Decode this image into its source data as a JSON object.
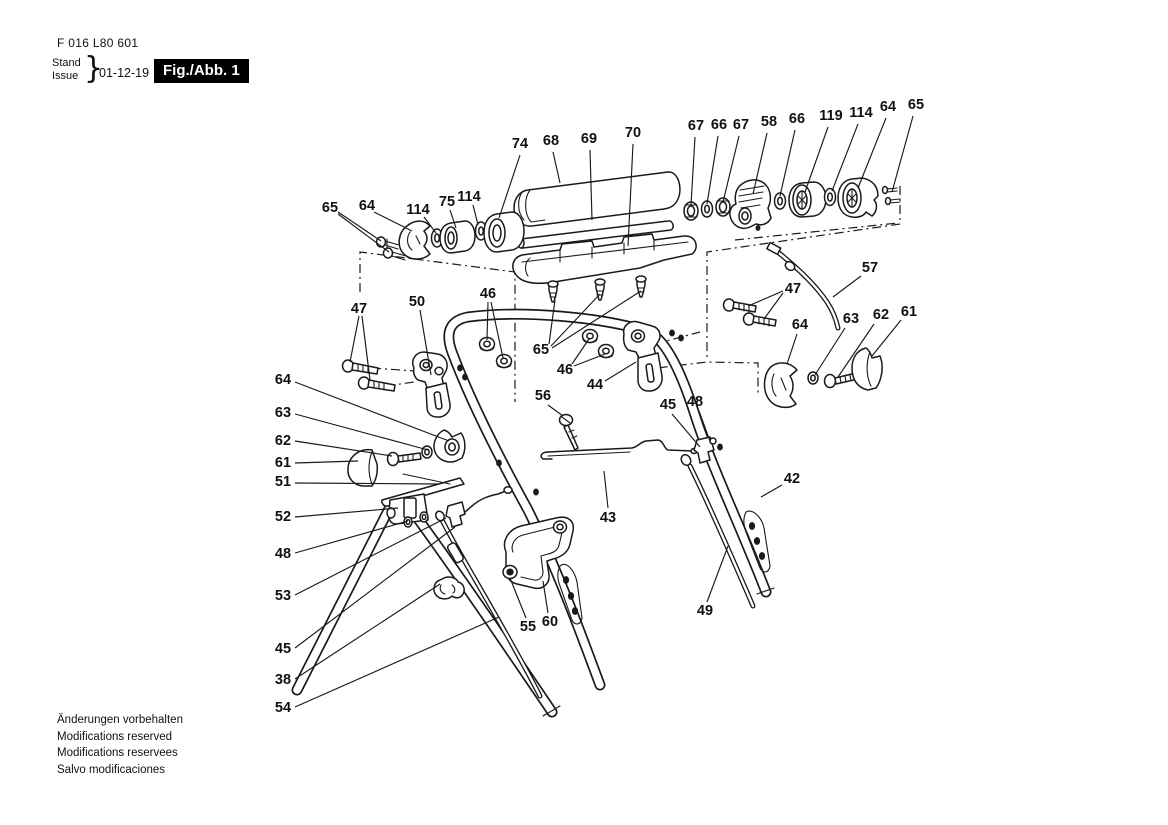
{
  "header": {
    "doc_number": "F 016 L80 601",
    "stand_label": "Stand",
    "issue_label": "Issue",
    "brace": "}",
    "date": "01-12-19",
    "figure_label": "Fig./Abb. 1"
  },
  "footer": {
    "lines": [
      "Änderungen vorbehalten",
      "Modifications reserved",
      "Modifications reservees",
      "Salvo modificaciones"
    ]
  },
  "colors": {
    "ink": "#1a1a1a",
    "figure_box_bg": "#000000",
    "figure_box_text": "#ffffff",
    "paper": "#ffffff"
  },
  "diagram": {
    "description": "Exploded-view spare parts drawing of a lawn-mower upper/lower handle assembly",
    "parts": [
      {
        "num": "74",
        "x": 520,
        "y": 148,
        "leaders": [
          [
            520,
            155,
            499,
            218
          ]
        ]
      },
      {
        "num": "68",
        "x": 551,
        "y": 145,
        "leaders": [
          [
            553,
            152,
            560,
            183
          ]
        ]
      },
      {
        "num": "69",
        "x": 589,
        "y": 143,
        "leaders": [
          [
            590,
            150,
            592,
            220
          ]
        ]
      },
      {
        "num": "70",
        "x": 633,
        "y": 137,
        "leaders": [
          [
            633,
            144,
            628,
            246
          ]
        ]
      },
      {
        "num": "67",
        "x": 696,
        "y": 130,
        "leaders": [
          [
            695,
            137,
            691,
            205
          ]
        ]
      },
      {
        "num": "66",
        "x": 719,
        "y": 129,
        "leaders": [
          [
            718,
            136,
            707,
            204
          ]
        ]
      },
      {
        "num": "67",
        "x": 741,
        "y": 129,
        "leaders": [
          [
            739,
            136,
            723,
            202
          ]
        ]
      },
      {
        "num": "58",
        "x": 769,
        "y": 126,
        "leaders": [
          [
            767,
            133,
            753,
            194
          ]
        ]
      },
      {
        "num": "66",
        "x": 797,
        "y": 123,
        "leaders": [
          [
            795,
            130,
            780,
            196
          ]
        ]
      },
      {
        "num": "119",
        "x": 831,
        "y": 120,
        "leaders": [
          [
            828,
            127,
            805,
            192
          ]
        ]
      },
      {
        "num": "114",
        "x": 861,
        "y": 117,
        "leaders": [
          [
            858,
            124,
            832,
            191
          ]
        ]
      },
      {
        "num": "64",
        "x": 888,
        "y": 111,
        "leaders": [
          [
            886,
            118,
            858,
            188
          ]
        ]
      },
      {
        "num": "65",
        "x": 916,
        "y": 109,
        "leaders": [
          [
            913,
            116,
            892,
            192
          ]
        ]
      },
      {
        "num": "65",
        "x": 330,
        "y": 212,
        "leaders": [
          [
            338,
            212,
            381,
            241
          ],
          [
            338,
            214,
            389,
            252
          ]
        ]
      },
      {
        "num": "64",
        "x": 367,
        "y": 210,
        "leaders": [
          [
            374,
            212,
            412,
            231
          ]
        ]
      },
      {
        "num": "114",
        "x": 418,
        "y": 214,
        "leaders": [
          [
            424,
            217,
            436,
            233
          ]
        ]
      },
      {
        "num": "75",
        "x": 447,
        "y": 206,
        "leaders": [
          [
            450,
            210,
            456,
            228
          ]
        ]
      },
      {
        "num": "114",
        "x": 469,
        "y": 201,
        "leaders": [
          [
            473,
            205,
            478,
            225
          ]
        ]
      },
      {
        "num": "47",
        "x": 359,
        "y": 313,
        "leaders": [
          [
            359,
            316,
            350,
            362
          ],
          [
            362,
            316,
            370,
            380
          ]
        ]
      },
      {
        "num": "50",
        "x": 417,
        "y": 306,
        "leaders": [
          [
            420,
            310,
            431,
            375
          ]
        ]
      },
      {
        "num": "46",
        "x": 488,
        "y": 298,
        "leaders": [
          [
            488,
            302,
            487,
            340
          ],
          [
            491,
            302,
            503,
            358
          ]
        ]
      },
      {
        "num": "65",
        "x": 541,
        "y": 354,
        "leaders": [
          [
            549,
            344,
            555,
            300
          ],
          [
            551,
            346,
            600,
            294
          ],
          [
            552,
            348,
            641,
            291
          ]
        ]
      },
      {
        "num": "46",
        "x": 565,
        "y": 374,
        "leaders": [
          [
            572,
            364,
            589,
            339
          ],
          [
            574,
            366,
            605,
            354
          ]
        ]
      },
      {
        "num": "44",
        "x": 595,
        "y": 389,
        "leaders": [
          [
            605,
            381,
            636,
            362
          ]
        ]
      },
      {
        "num": "56",
        "x": 543,
        "y": 400,
        "leaders": [
          [
            548,
            405,
            563,
            416
          ]
        ]
      },
      {
        "num": "47",
        "x": 793,
        "y": 293,
        "leaders": [
          [
            783,
            291,
            748,
            306
          ],
          [
            783,
            293,
            764,
            319
          ]
        ]
      },
      {
        "num": "57",
        "x": 870,
        "y": 272,
        "leaders": [
          [
            861,
            276,
            833,
            297
          ]
        ]
      },
      {
        "num": "64",
        "x": 800,
        "y": 329,
        "leaders": [
          [
            797,
            334,
            787,
            364
          ]
        ]
      },
      {
        "num": "63",
        "x": 851,
        "y": 323,
        "leaders": [
          [
            845,
            328,
            815,
            375
          ]
        ]
      },
      {
        "num": "62",
        "x": 881,
        "y": 319,
        "leaders": [
          [
            874,
            324,
            838,
            377
          ]
        ]
      },
      {
        "num": "61",
        "x": 909,
        "y": 316,
        "leaders": [
          [
            901,
            320,
            872,
            356
          ]
        ]
      },
      {
        "num": "64",
        "x": 283,
        "y": 384,
        "leaders": [
          [
            295,
            382,
            449,
            441
          ]
        ]
      },
      {
        "num": "63",
        "x": 283,
        "y": 417,
        "leaders": [
          [
            295,
            414,
            428,
            450
          ]
        ]
      },
      {
        "num": "62",
        "x": 283,
        "y": 445,
        "leaders": [
          [
            295,
            441,
            392,
            456
          ]
        ]
      },
      {
        "num": "61",
        "x": 283,
        "y": 467,
        "leaders": [
          [
            295,
            463,
            358,
            461
          ]
        ]
      },
      {
        "num": "51",
        "x": 283,
        "y": 486,
        "leaders": [
          [
            295,
            483,
            438,
            484
          ]
        ]
      },
      {
        "num": "52",
        "x": 283,
        "y": 521,
        "leaders": [
          [
            295,
            517,
            398,
            508
          ]
        ]
      },
      {
        "num": "48",
        "x": 283,
        "y": 558,
        "leaders": [
          [
            295,
            553,
            408,
            521
          ]
        ]
      },
      {
        "num": "53",
        "x": 283,
        "y": 600,
        "leaders": [
          [
            295,
            595,
            446,
            518
          ]
        ]
      },
      {
        "num": "45",
        "x": 283,
        "y": 653,
        "leaders": [
          [
            295,
            648,
            455,
            527
          ]
        ]
      },
      {
        "num": "38",
        "x": 283,
        "y": 684,
        "leaders": [
          [
            295,
            679,
            440,
            584
          ]
        ]
      },
      {
        "num": "54",
        "x": 283,
        "y": 712,
        "leaders": [
          [
            295,
            707,
            499,
            617
          ]
        ]
      },
      {
        "num": "45",
        "x": 668,
        "y": 409,
        "leaders": [
          [
            672,
            414,
            700,
            447
          ]
        ]
      },
      {
        "num": "48",
        "x": 695,
        "y": 406,
        "leaders": [
          [
            699,
            411,
            711,
            444
          ]
        ]
      },
      {
        "num": "43",
        "x": 608,
        "y": 522,
        "leaders": [
          [
            608,
            508,
            604,
            471
          ]
        ]
      },
      {
        "num": "42",
        "x": 792,
        "y": 483,
        "leaders": [
          [
            782,
            485,
            761,
            497
          ]
        ]
      },
      {
        "num": "49",
        "x": 705,
        "y": 615,
        "leaders": [
          [
            707,
            602,
            728,
            546
          ]
        ]
      },
      {
        "num": "55",
        "x": 528,
        "y": 631,
        "leaders": [
          [
            526,
            618,
            510,
            578
          ]
        ]
      },
      {
        "num": "60",
        "x": 550,
        "y": 626,
        "leaders": [
          [
            548,
            613,
            543,
            581
          ]
        ]
      }
    ]
  }
}
